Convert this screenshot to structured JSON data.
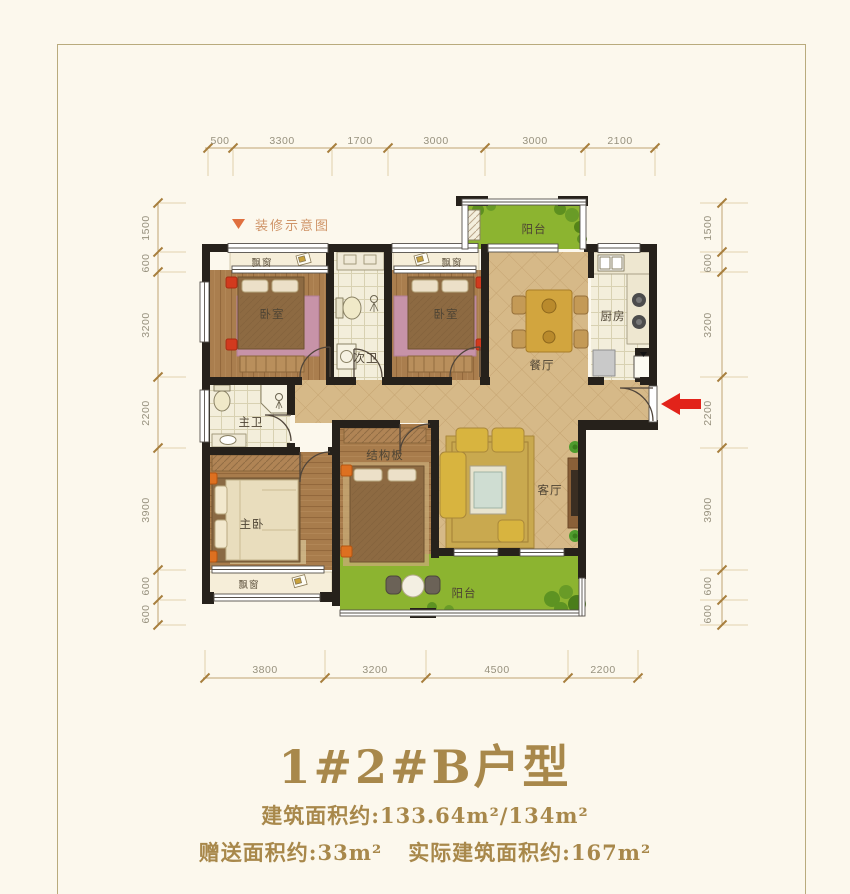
{
  "legend": {
    "marker": "▼",
    "label": "装修示意图"
  },
  "rooms": {
    "bay_tl": "飘窗",
    "bedroom_tl": "卧室",
    "bath_second": "次卫",
    "bay_tr": "飘窗",
    "bedroom_tr": "卧室",
    "balcony_top": "阳台",
    "kitchen": "厨房",
    "dining": "餐厅",
    "bath_master": "主卫",
    "bedroom_master": "主卧",
    "bay_master": "飘窗",
    "structure": "结构板",
    "living": "客厅",
    "balcony_bottom": "阳台"
  },
  "dimensions": {
    "top": [
      "500",
      "3300",
      "1700",
      "3000",
      "3000",
      "2100"
    ],
    "bottom": [
      "3800",
      "3200",
      "4500",
      "2200"
    ],
    "left": [
      "1500",
      "600",
      "3200",
      "2200",
      "3900",
      "600",
      "600"
    ],
    "right": [
      "1500",
      "600",
      "3200",
      "2200",
      "3900",
      "600",
      "600"
    ]
  },
  "title": "1#2#B户型",
  "areas": {
    "line1": "建筑面积约:133.64m²/134m²",
    "line2a": "赠送面积约:33m²",
    "line2b": "实际建筑面积约:167m²"
  },
  "colors": {
    "accent_gold": "#a8884b",
    "dimension_line": "#bfa472",
    "wall": "#26211b",
    "balcony_green": "#8cb430",
    "entry_arrow_red": "#e2231a"
  }
}
